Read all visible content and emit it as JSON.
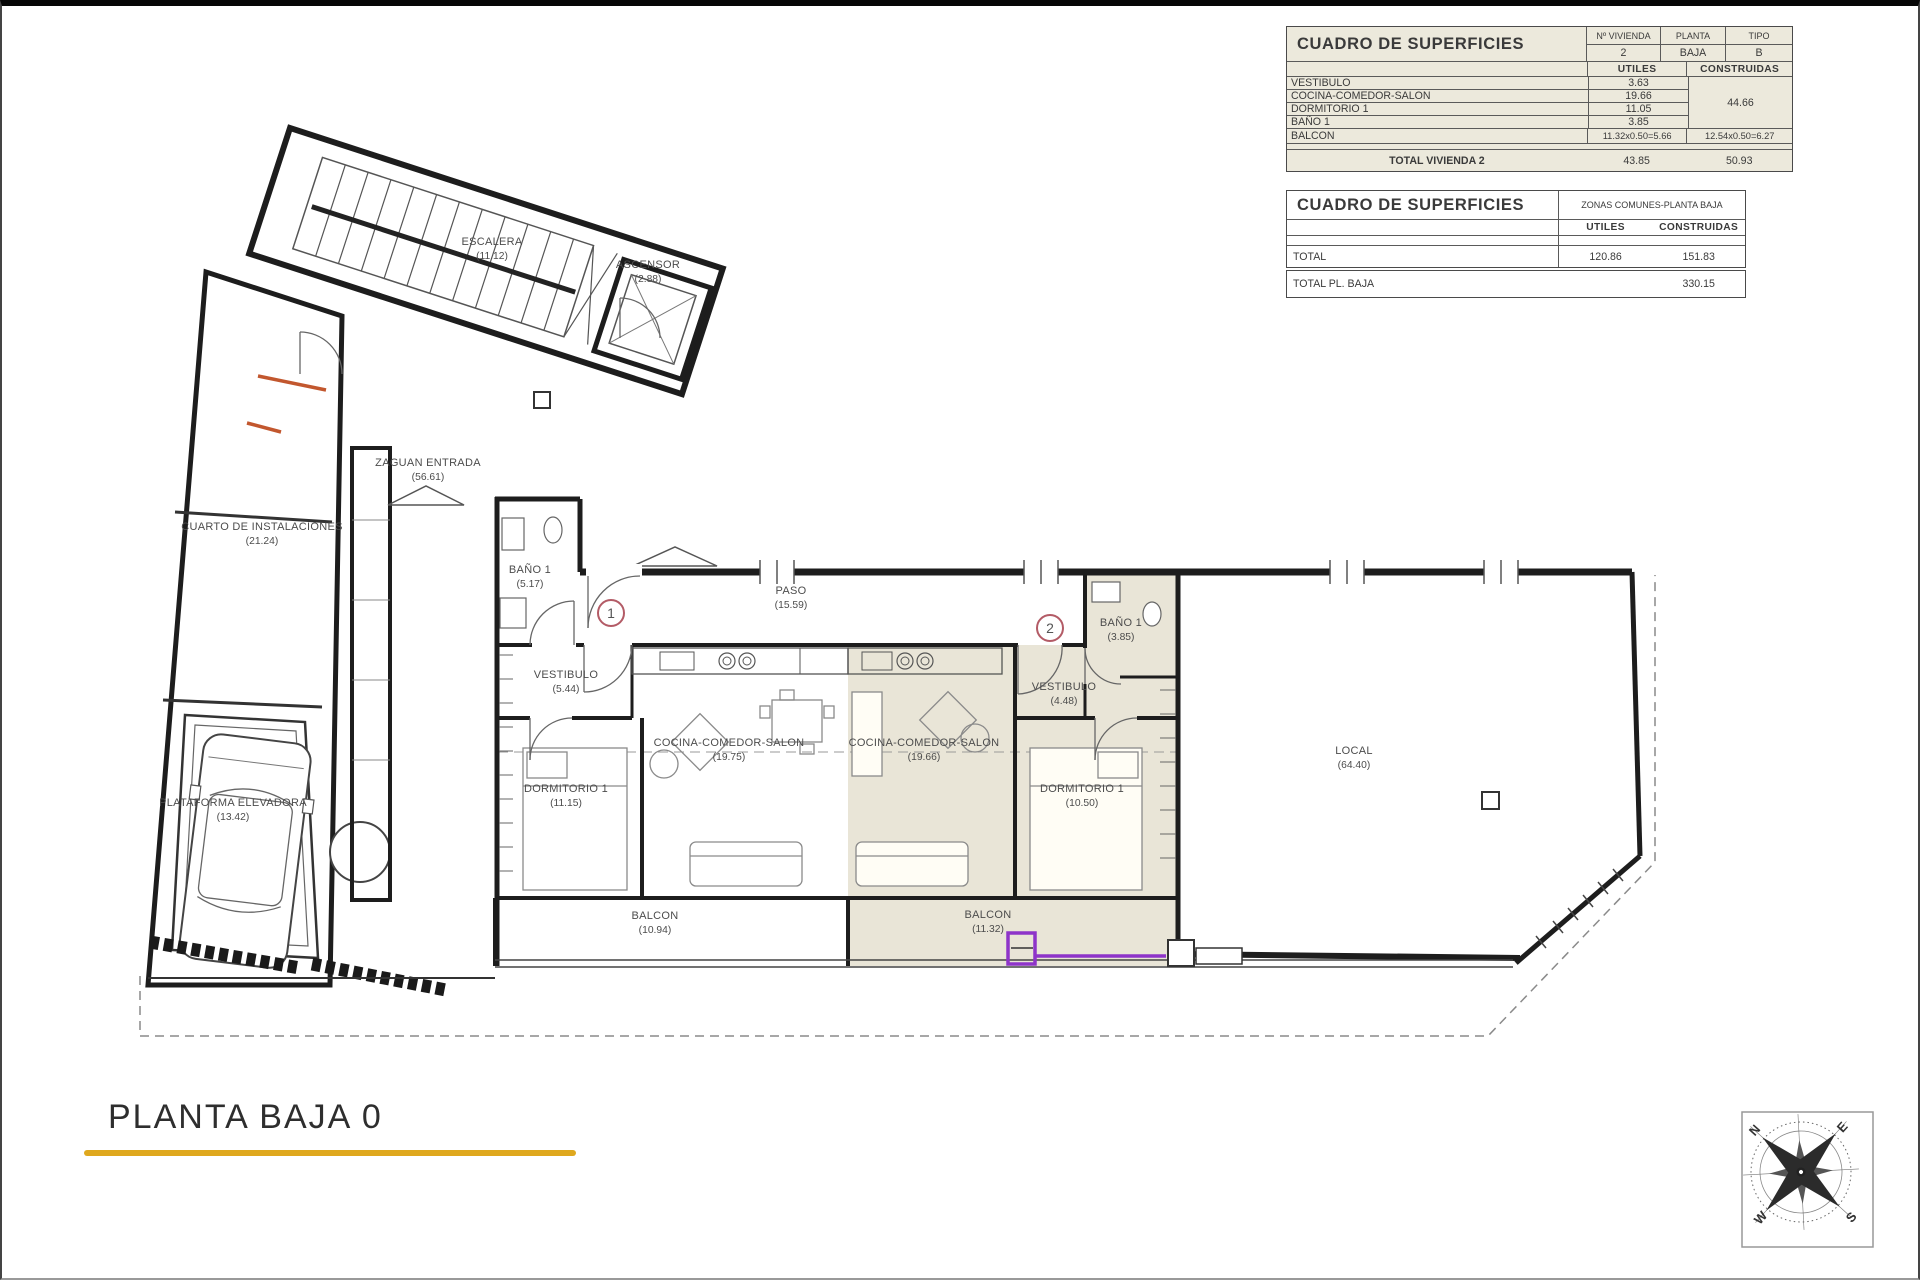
{
  "sheet": {
    "footer_title": "PLANTA BAJA 0"
  },
  "tables": {
    "vivienda": {
      "title": "CUADRO DE SUPERFICIES",
      "col_vivienda": "Nº VIVIENDA",
      "col_planta": "PLANTA",
      "col_tipo": "TIPO",
      "val_vivienda": "2",
      "val_planta": "BAJA",
      "val_tipo": "B",
      "col_utiles": "UTILES",
      "col_construidas": "CONSTRUIDAS",
      "rows": [
        {
          "label": "VESTIBULO",
          "utiles": "3.63"
        },
        {
          "label": "COCINA-COMEDOR-SALON",
          "utiles": "19.66"
        },
        {
          "label": "DORMITORIO 1",
          "utiles": "11.05"
        },
        {
          "label": "BAÑO 1",
          "utiles": "3.85"
        }
      ],
      "construidas_merged": "44.66",
      "balcon": {
        "label": "BALCON",
        "utiles": "11.32x0.50=5.66",
        "construidas": "12.54x0.50=6.27"
      },
      "total": {
        "label": "TOTAL VIVIENDA 2",
        "utiles": "43.85",
        "construidas": "50.93"
      }
    },
    "comunes": {
      "title": "CUADRO DE SUPERFICIES",
      "subtitle": "ZONAS COMUNES-PLANTA BAJA",
      "col_utiles": "UTILES",
      "col_construidas": "CONSTRUIDAS",
      "total": {
        "label": "TOTAL",
        "utiles": "120.86",
        "construidas": "151.83"
      }
    },
    "total_planta": {
      "label": "TOTAL PL. BAJA",
      "value": "330.15"
    }
  },
  "plan": {
    "rooms": [
      {
        "name": "ESCALERA",
        "area": "(11.12)"
      },
      {
        "name": "ASCENSOR",
        "area": "(2.88)"
      },
      {
        "name": "ZAGUAN ENTRADA",
        "area": "(56.61)"
      },
      {
        "name": "CUARTO DE INSTALACIONES",
        "area": "(21.24)"
      },
      {
        "name": "PLATAFORMA ELEVADORA",
        "area": "(13.42)"
      },
      {
        "name": "BAÑO 1",
        "area": "(5.17)"
      },
      {
        "name": "VESTIBULO",
        "area": "(5.44)"
      },
      {
        "name": "PASO",
        "area": "(15.59)"
      },
      {
        "name": "COCINA-COMEDOR-SALON",
        "area": "(19.75)"
      },
      {
        "name": "DORMITORIO 1",
        "area": "(11.15)"
      },
      {
        "name": "BALCON",
        "area": "(10.94)"
      },
      {
        "name": "BAÑO 1",
        "area": "(3.85)"
      },
      {
        "name": "VESTIBULO",
        "area": "(4.48)"
      },
      {
        "name": "COCINA-COMEDOR-SALON",
        "area": "(19.66)"
      },
      {
        "name": "DORMITORIO 1",
        "area": "(10.50)"
      },
      {
        "name": "BALCON",
        "area": "(11.32)"
      },
      {
        "name": "LOCAL",
        "area": "(64.40)"
      }
    ],
    "markers": {
      "vivienda1": "1",
      "vivienda2": "2"
    }
  },
  "compass": {
    "n": "N",
    "e": "E",
    "s": "S",
    "w": "W"
  },
  "colors": {
    "accent_underline": "#DFA81E",
    "highlight_purple": "#8E34C9",
    "marker_red": "#B35B66",
    "shading_beige": "#E9E5D7",
    "compass_north_red": "#C0392B"
  }
}
